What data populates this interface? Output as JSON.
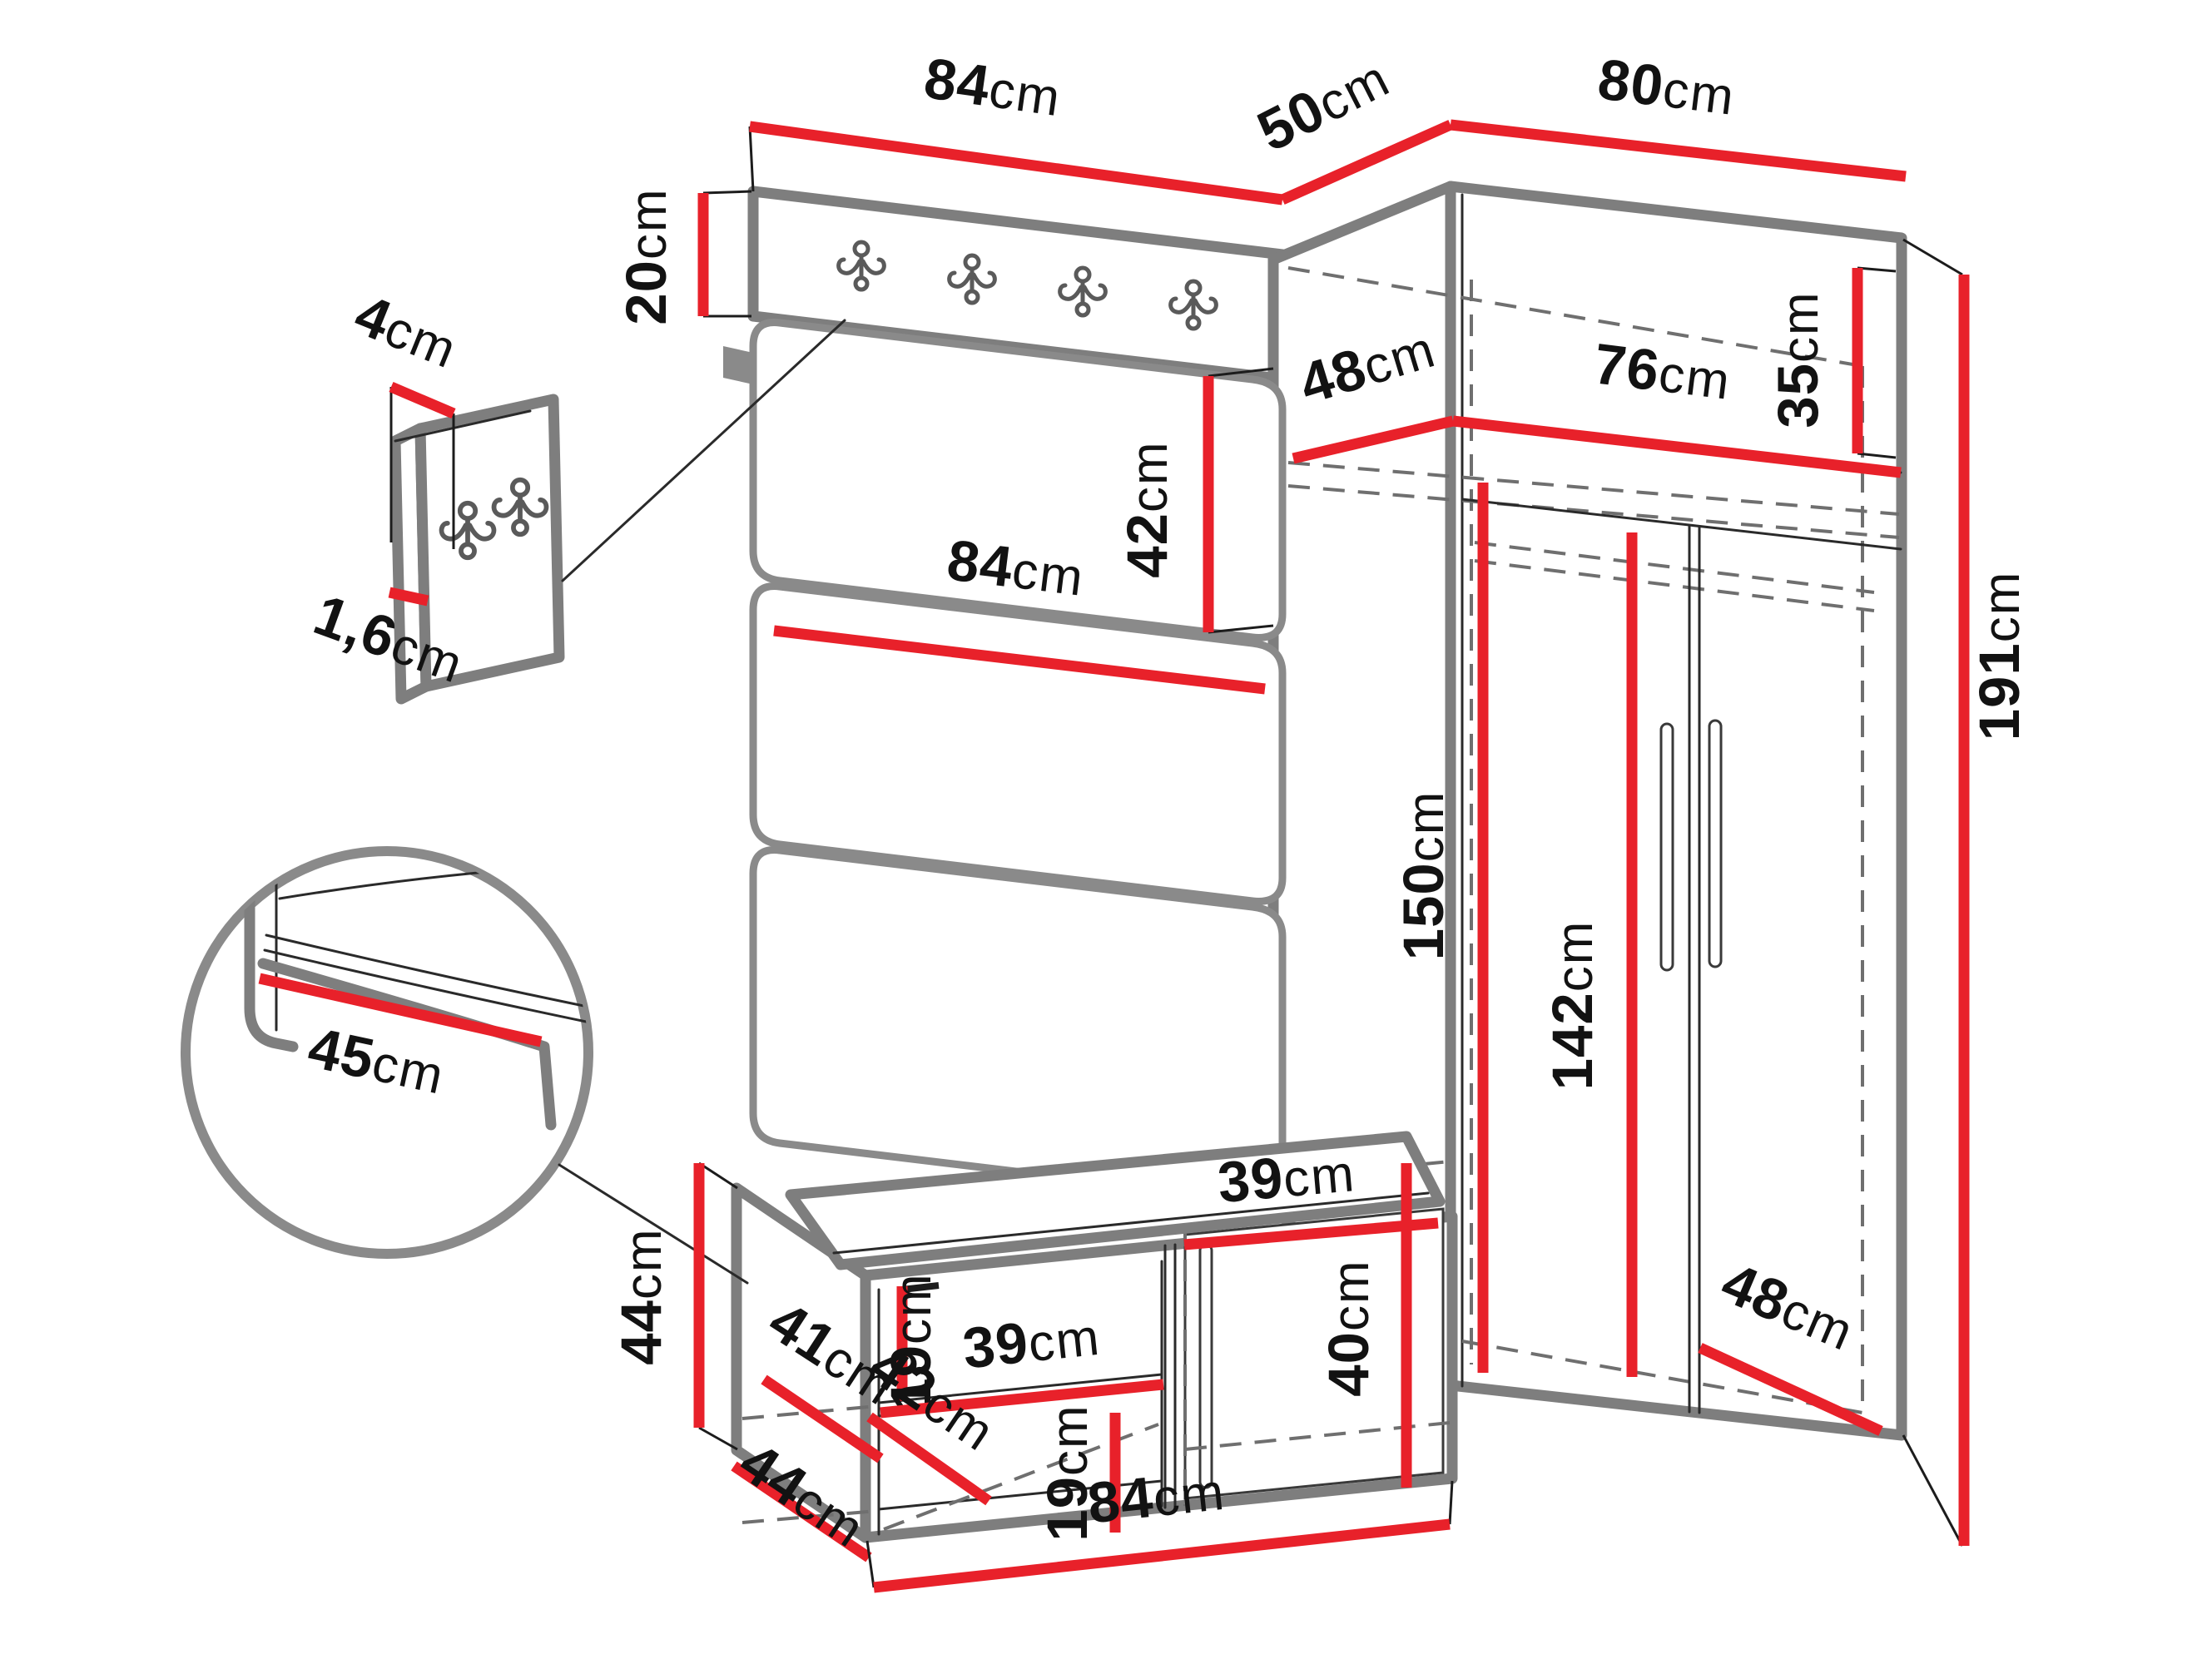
{
  "figure": {
    "type": "furniture-dimension-diagram",
    "subject": "hallway set: coat rack panel with hooks, upholstered wall panels, shoe bench with cushion, corner wardrobe",
    "unit": "cm",
    "colors": {
      "dimension_line": "#e8212a",
      "structure_edge": "#7e7e7e",
      "label_text": "#121212",
      "background": "#ffffff"
    }
  },
  "icons": {
    "strip_hook_count": 4,
    "detail_panel_hook_count": 2,
    "hook_type": "double-hook-icon"
  },
  "dims": {
    "top_panel_width": {
      "value": "84",
      "unit": "cm"
    },
    "corner_side_depth": {
      "value": "50",
      "unit": "cm"
    },
    "wardrobe_width": {
      "value": "80",
      "unit": "cm"
    },
    "hook_strip_height": {
      "value": "20",
      "unit": "cm"
    },
    "hook_plate_width": {
      "value": "4",
      "unit": "cm"
    },
    "hook_panel_thickness": {
      "value": "1,6",
      "unit": "cm"
    },
    "upholstered_panel_height": {
      "value": "42",
      "unit": "cm"
    },
    "upholstered_panel_width": {
      "value": "84",
      "unit": "cm"
    },
    "seat_cushion_depth": {
      "value": "45",
      "unit": "cm"
    },
    "wardrobe_shelf_depth": {
      "value": "48",
      "unit": "cm"
    },
    "wardrobe_shelf_width": {
      "value": "76",
      "unit": "cm"
    },
    "wardrobe_top_height": {
      "value": "35",
      "unit": "cm"
    },
    "wardrobe_interior_height": {
      "value": "150",
      "unit": "cm"
    },
    "wardrobe_door_height": {
      "value": "142",
      "unit": "cm"
    },
    "wardrobe_height": {
      "value": "191",
      "unit": "cm"
    },
    "bench_upper_gap_height": {
      "value": "19",
      "unit": "cm"
    },
    "bench_shelf_width": {
      "value": "39",
      "unit": "cm"
    },
    "bench_shelf_depth": {
      "value": "41",
      "unit": "cm"
    },
    "bench_bottom_depth": {
      "value": "42",
      "unit": "cm"
    },
    "bench_lower_gap_height": {
      "value": "19",
      "unit": "cm"
    },
    "bench_door_width": {
      "value": "39",
      "unit": "cm"
    },
    "bench_door_height": {
      "value": "40",
      "unit": "cm"
    },
    "bench_height": {
      "value": "44",
      "unit": "cm"
    },
    "bench_depth": {
      "value": "44",
      "unit": "cm"
    },
    "bench_width": {
      "value": "84",
      "unit": "cm"
    },
    "wardrobe_bottom_depth": {
      "value": "48",
      "unit": "cm"
    }
  }
}
